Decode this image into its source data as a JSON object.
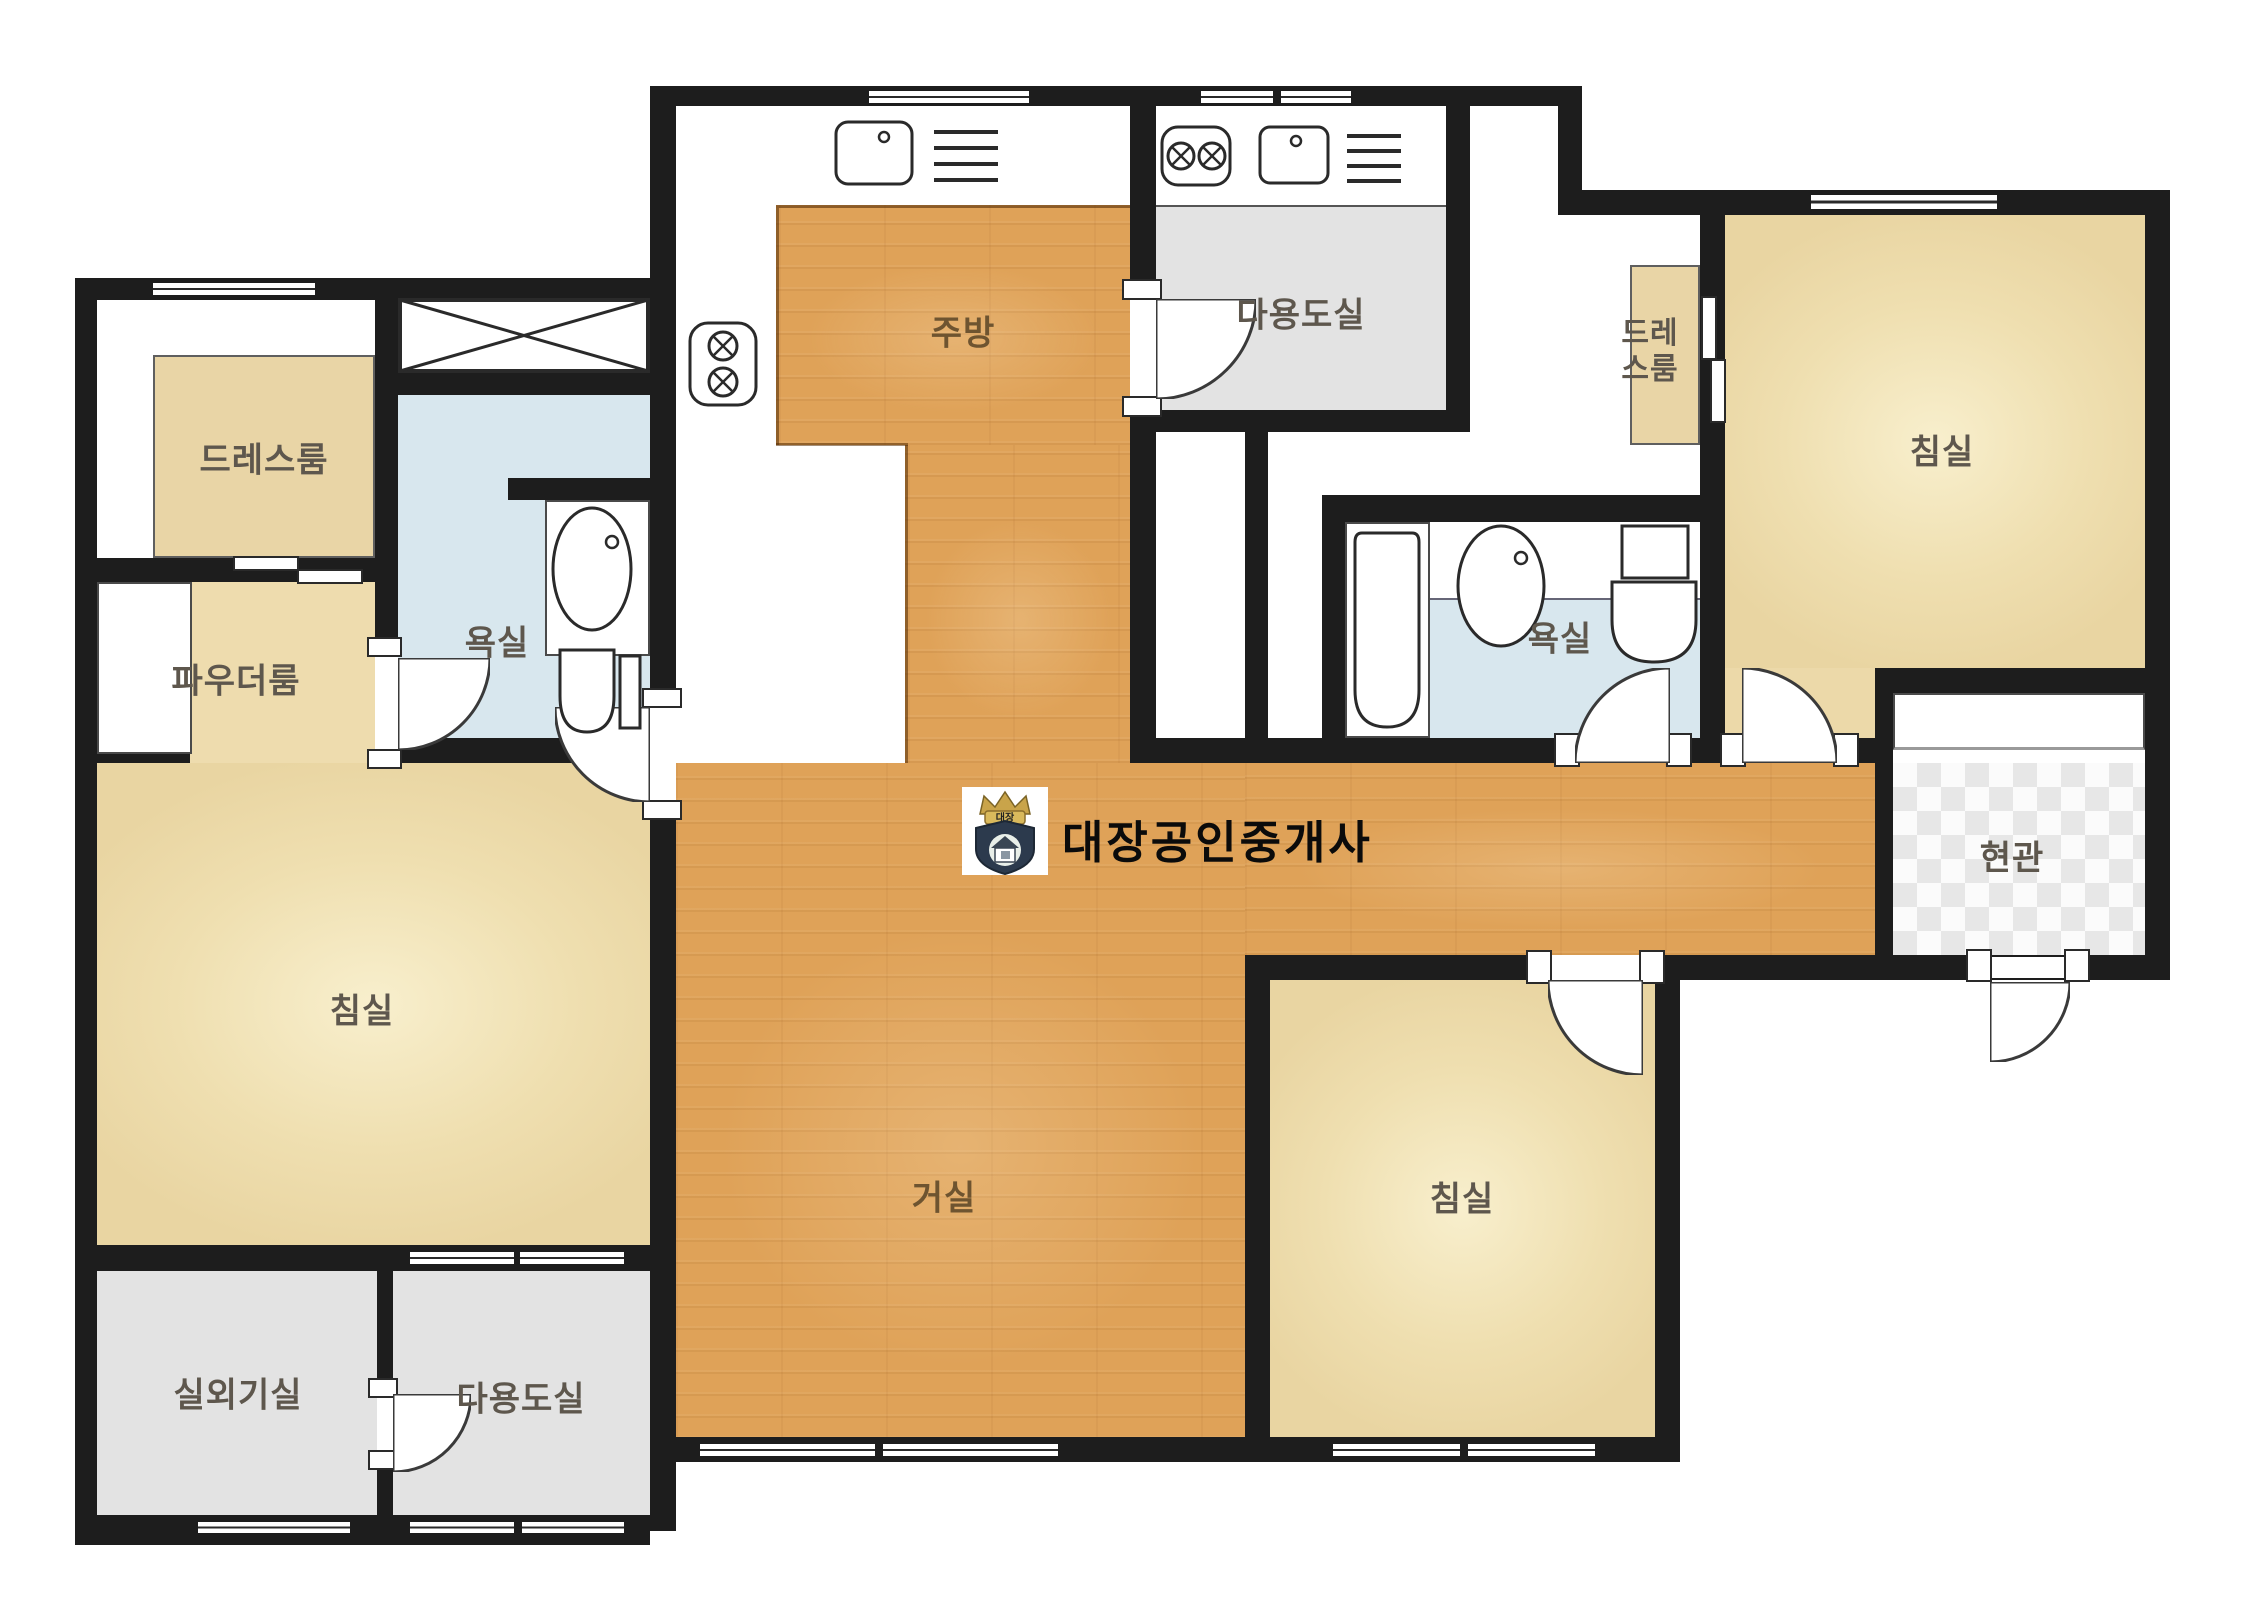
{
  "document": {
    "type": "apartment-floor-plan"
  },
  "watermark": {
    "brand_text": "대장공인중개사",
    "logo_badge_text": "대장"
  },
  "rooms": {
    "dressroom_left": {
      "label": "드레스룸"
    },
    "powder_room": {
      "label": "파우더룸"
    },
    "bathroom_left": {
      "label": "욕실"
    },
    "bedroom_left": {
      "label": "침실"
    },
    "outdoor_unit_room": {
      "label": "실외기실"
    },
    "utility_room_bottom": {
      "label": "다용도실"
    },
    "kitchen": {
      "label": "주방"
    },
    "living_room": {
      "label": "거실"
    },
    "utility_room_top": {
      "label": "다용도실"
    },
    "dressroom_right": {
      "label": "드레스룸"
    },
    "bathroom_right": {
      "label": "욕실"
    },
    "bedroom_right": {
      "label": "침실"
    },
    "bedroom_bottom": {
      "label": "침실"
    },
    "entrance": {
      "label": "현관"
    }
  },
  "fixtures": [
    "kitchen-sink",
    "dish-rack",
    "gas-stove-2burner",
    "gas-stove-vertical-2burner",
    "wash-basin",
    "toilet",
    "bathtub",
    "storage-closet-x",
    "powder-counter",
    "shoe-cabinet",
    "swing-door",
    "sliding-door",
    "window"
  ],
  "colors": {
    "wall": "#1d1d1d",
    "wood_floor": "#dfa258",
    "bedroom_floor": "#efdfb0",
    "dressroom_floor": "#e9d5a6",
    "bathroom_floor": "#d8e7ee",
    "utility_floor": "#e3e3e3",
    "entrance_checker": "#e7e7e7",
    "label_text": "#5e574d",
    "watermark_text": "#0b0b0b",
    "logo_gold": "#c9a44a",
    "logo_navy": "#2c3a4d"
  }
}
